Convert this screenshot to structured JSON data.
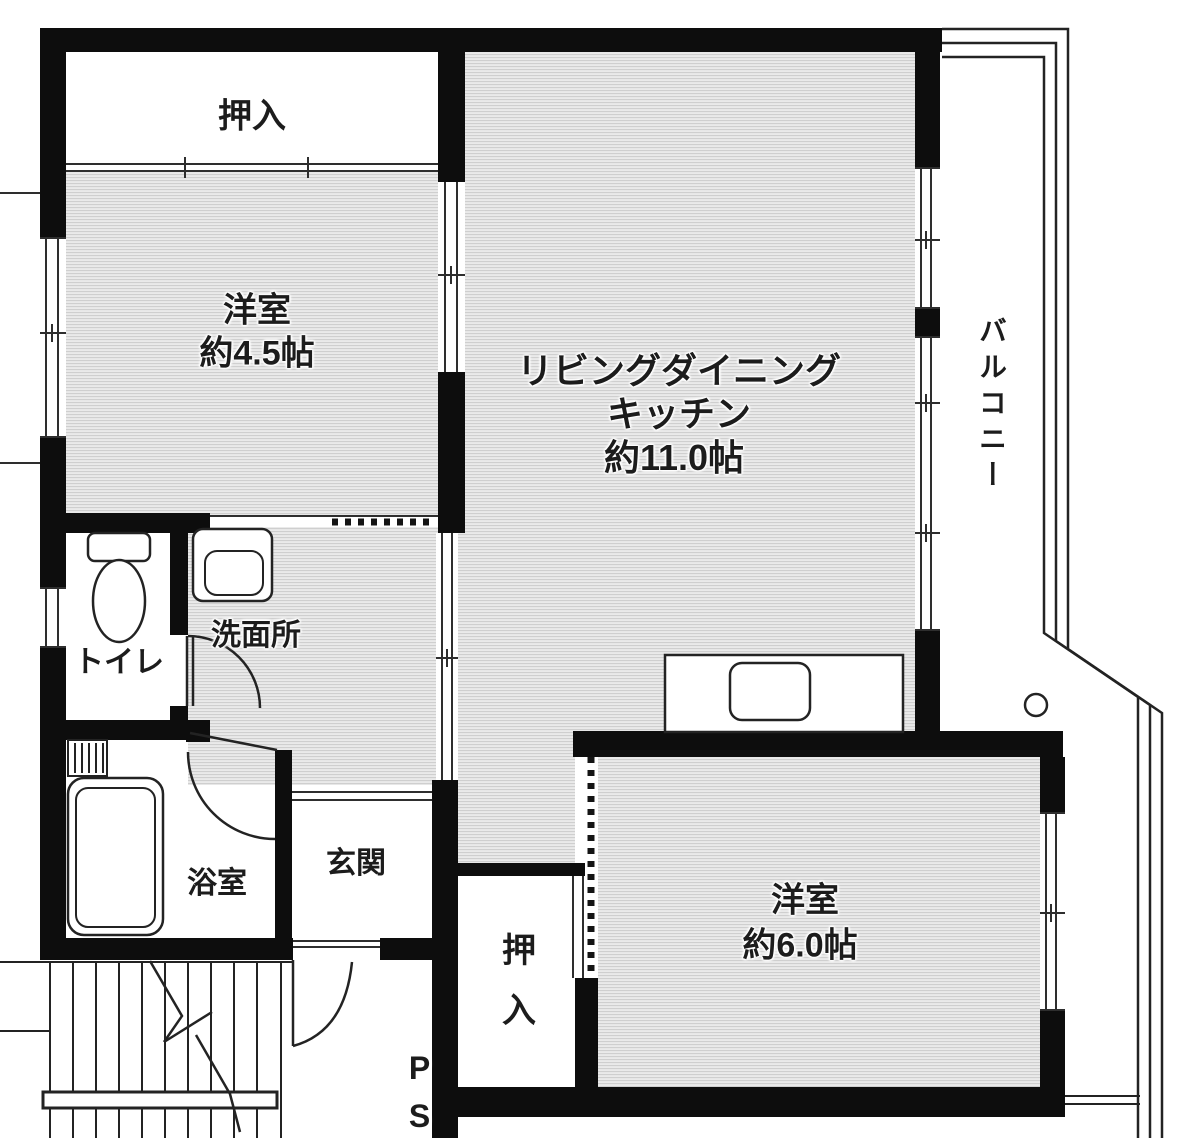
{
  "rooms": {
    "closet_top": {
      "label": "押入"
    },
    "bedroom_small": {
      "name": "洋室",
      "size": "約4.5帖"
    },
    "ldk": {
      "line1": "リビングダイニング",
      "line2": "キッチン",
      "line3": "約11.0帖"
    },
    "balcony": {
      "label": "バルコニー"
    },
    "toilet": {
      "label": "トイレ"
    },
    "washroom": {
      "label": "洗面所"
    },
    "bathroom": {
      "label": "浴室"
    },
    "entrance": {
      "label": "玄関"
    },
    "closet_bottom": {
      "label": "押入"
    },
    "bedroom_large": {
      "name": "洋室",
      "size": "約6.0帖"
    },
    "pipe_space": {
      "label": "PS"
    }
  },
  "colors": {
    "wall": "#0d0d0d",
    "floor_base": "#eaeaea",
    "floor_stripe": "#cfcfcf",
    "line": "#2e2e2e",
    "text": "#1c1c1c"
  }
}
